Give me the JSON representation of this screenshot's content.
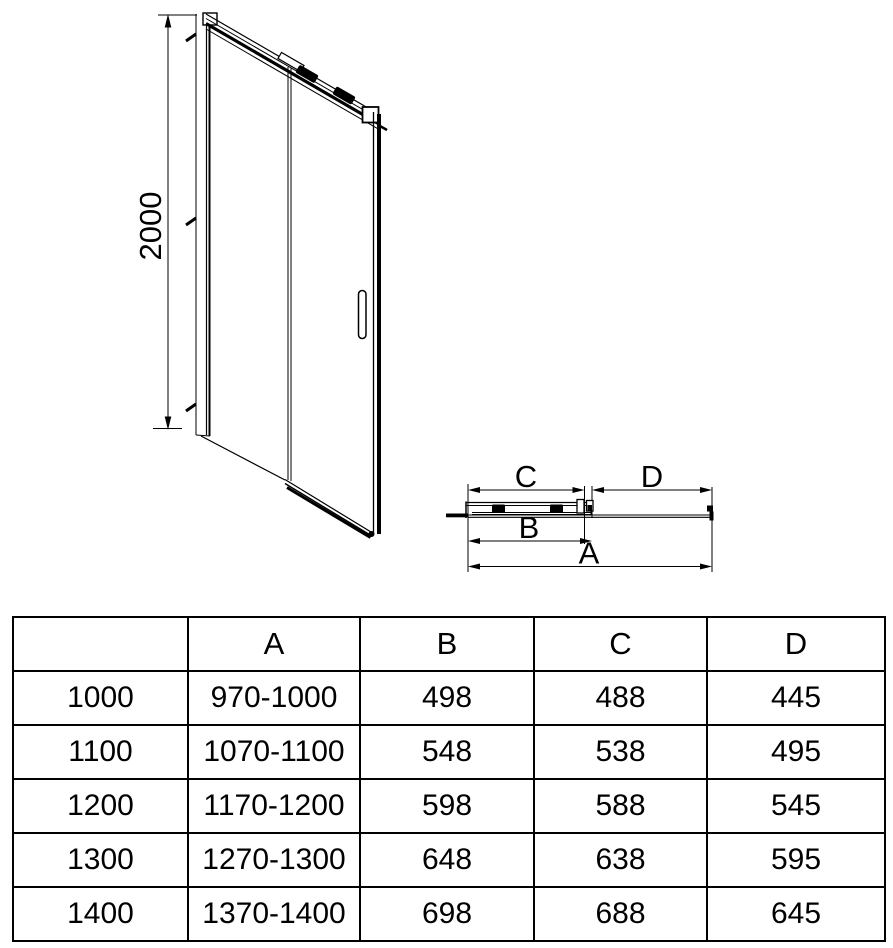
{
  "diagram": {
    "front_view": {
      "height_dimension": "2000"
    },
    "plan_view": {
      "dim_a_label": "A",
      "dim_b_label": "B",
      "dim_c_label": "C",
      "dim_d_label": "D"
    }
  },
  "table": {
    "headers": {
      "size": "",
      "a": "A",
      "b": "B",
      "c": "C",
      "d": "D"
    },
    "rows": [
      {
        "size": "1000",
        "a": "970-1000",
        "b": "498",
        "c": "488",
        "d": "445"
      },
      {
        "size": "1100",
        "a": "1070-1100",
        "b": "548",
        "c": "538",
        "d": "495"
      },
      {
        "size": "1200",
        "a": "1170-1200",
        "b": "598",
        "c": "588",
        "d": "545"
      },
      {
        "size": "1300",
        "a": "1270-1300",
        "b": "648",
        "c": "638",
        "d": "595"
      },
      {
        "size": "1400",
        "a": "1370-1400",
        "b": "698",
        "c": "688",
        "d": "645"
      }
    ]
  },
  "colors": {
    "line": "#000000",
    "background": "#ffffff"
  }
}
